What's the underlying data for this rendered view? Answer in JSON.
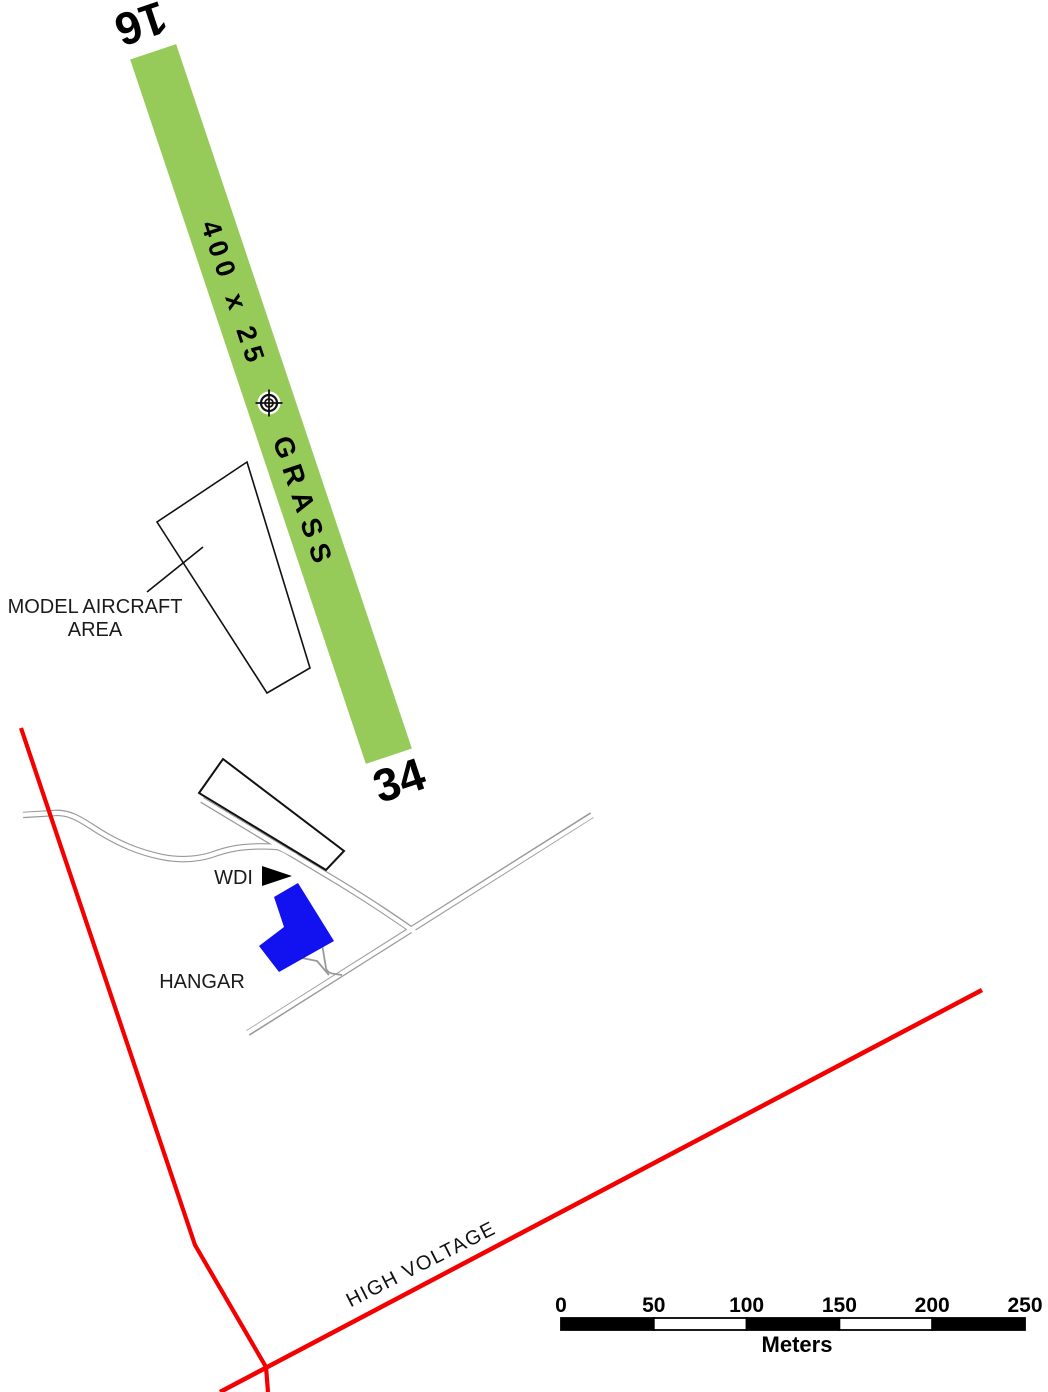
{
  "map": {
    "runway": {
      "designator_north": "16",
      "designator_south": "34",
      "dimensions_label": "400 x 25",
      "surface_label": "GRASS"
    },
    "labels": {
      "model_aircraft_line1": "MODEL AIRCRAFT",
      "model_aircraft_line2": "AREA",
      "wdi": "WDI",
      "hangar": "HANGAR",
      "high_voltage": "HIGH VOLTAGE"
    },
    "scalebar": {
      "labels": [
        "0",
        "50",
        "100",
        "150",
        "200",
        "250"
      ],
      "unit": "Meters"
    },
    "colors": {
      "runway_green": "#97CB59",
      "hangar_blue": "#1212F0",
      "high_voltage_red": "#F40000",
      "road_gray": "#999999"
    }
  }
}
